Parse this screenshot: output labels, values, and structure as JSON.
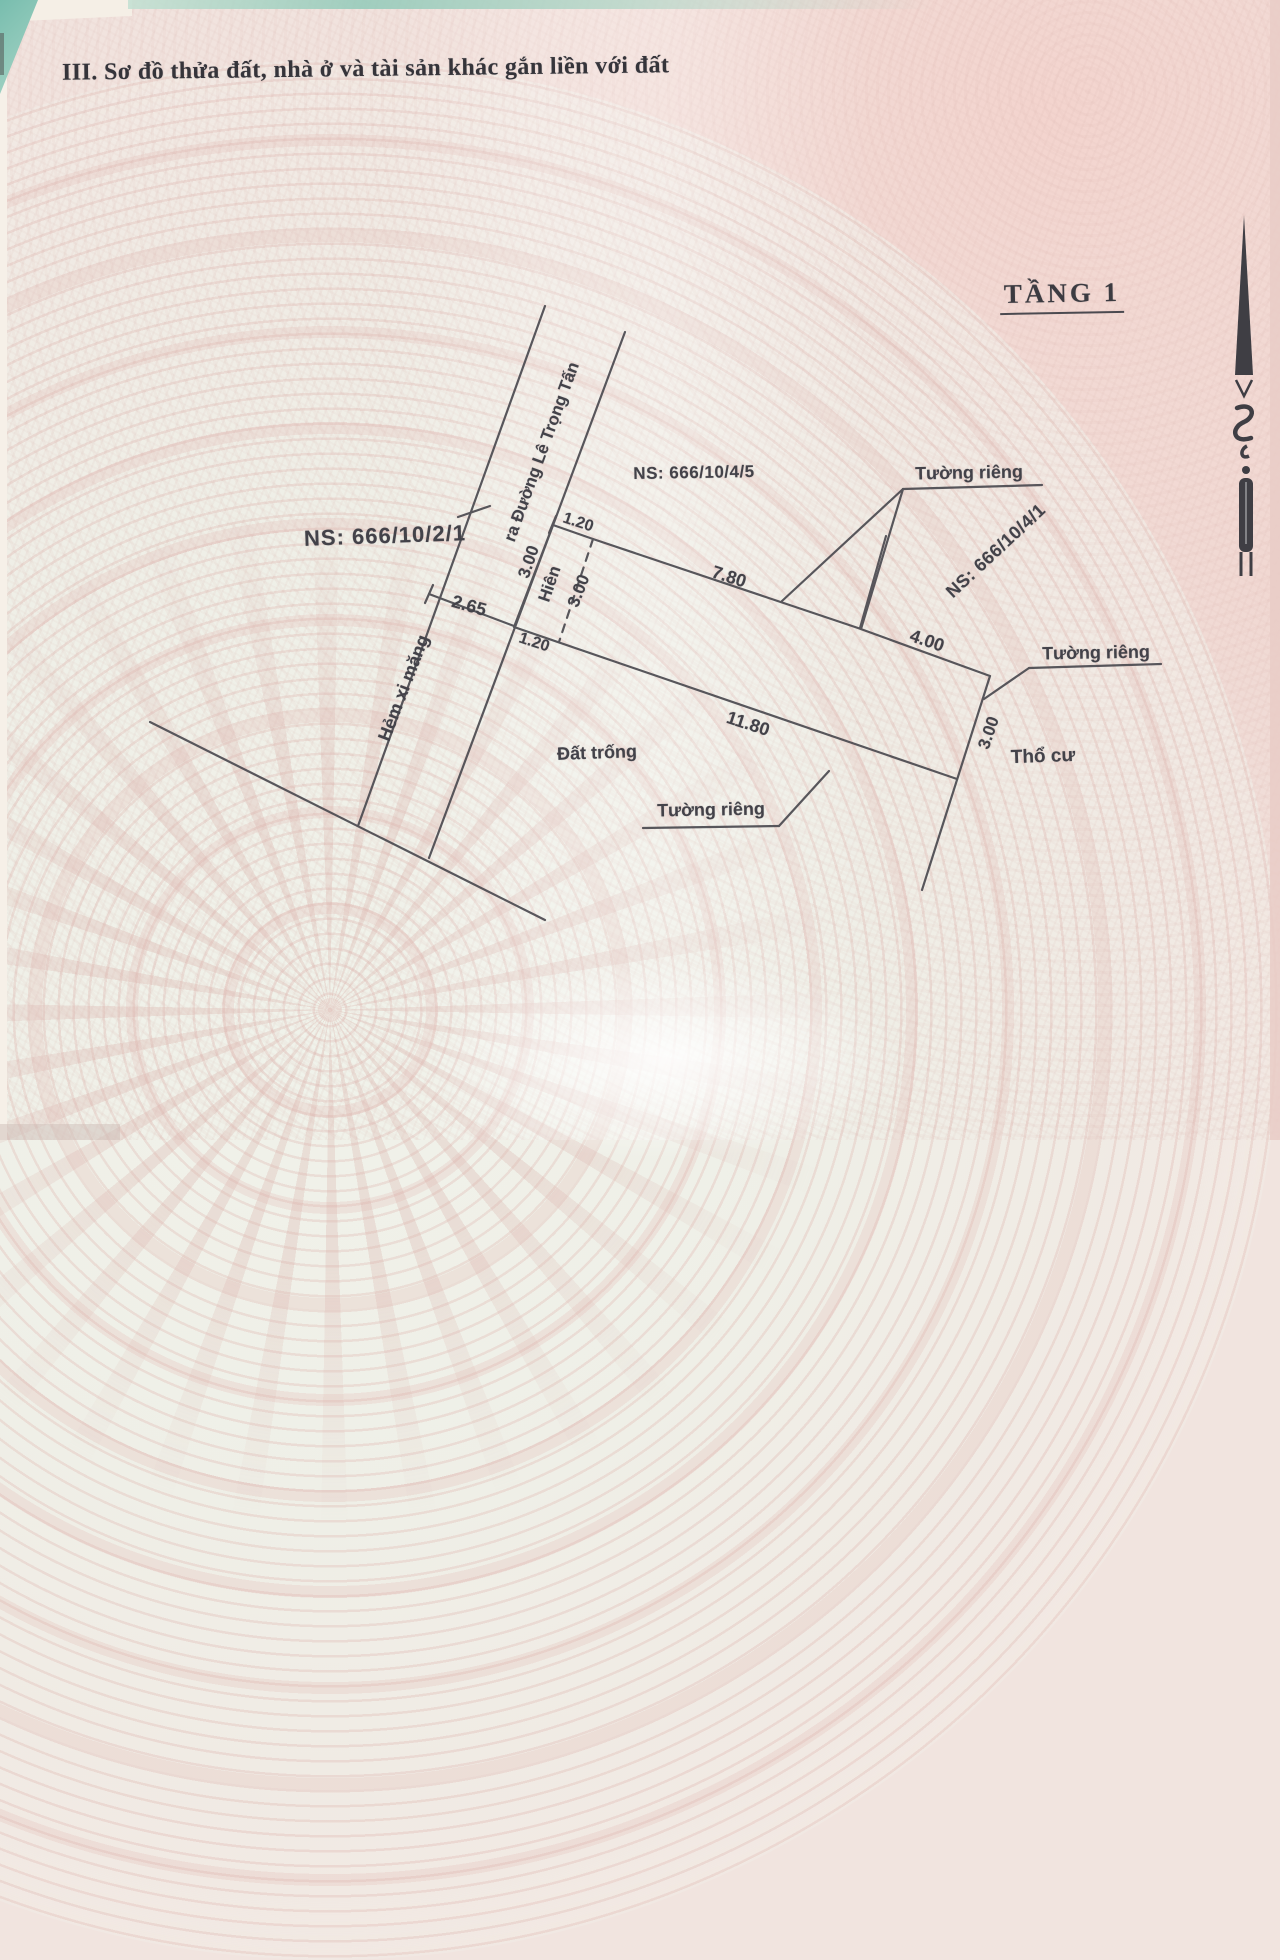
{
  "document": {
    "section_title": "III. Sơ đồ thửa đất, nhà ở và tài sản khác gắn liền với đất",
    "floor_title": "TẦNG 1"
  },
  "adjacent_parcels": {
    "west": "NS: 666/10/2/1",
    "north": "NS: 666/10/4/5",
    "east": "NS: 666/10/4/1"
  },
  "road": {
    "alley_label": "Hẻm xi măng",
    "street_direction_label": "ra Đường Lê Trọng Tấn",
    "width_m": "2.65"
  },
  "zones": {
    "porch": "Hiên",
    "vacant_land": "Đất trống",
    "residential_land": "Thổ cư"
  },
  "walls": {
    "top_label": "Tường riêng",
    "east_label": "Tường riêng",
    "south_label": "Tường riêng"
  },
  "dimensions": {
    "porch_front": "1.20",
    "porch_side_road": "3.00",
    "porch_depth": "3.00",
    "porch_rear": "1.20",
    "north_edge_main": "7.80",
    "north_edge_rear": "4.00",
    "east_edge": "3.00",
    "south_edge": "11.80"
  },
  "icons": {
    "north_arrow": "north-arrow"
  },
  "palette": {
    "ink": "#4b4a50",
    "paper_pink": "#f1e3de",
    "emblem_light": "#f0f1e9",
    "accent_teal": "#85c3b3"
  }
}
